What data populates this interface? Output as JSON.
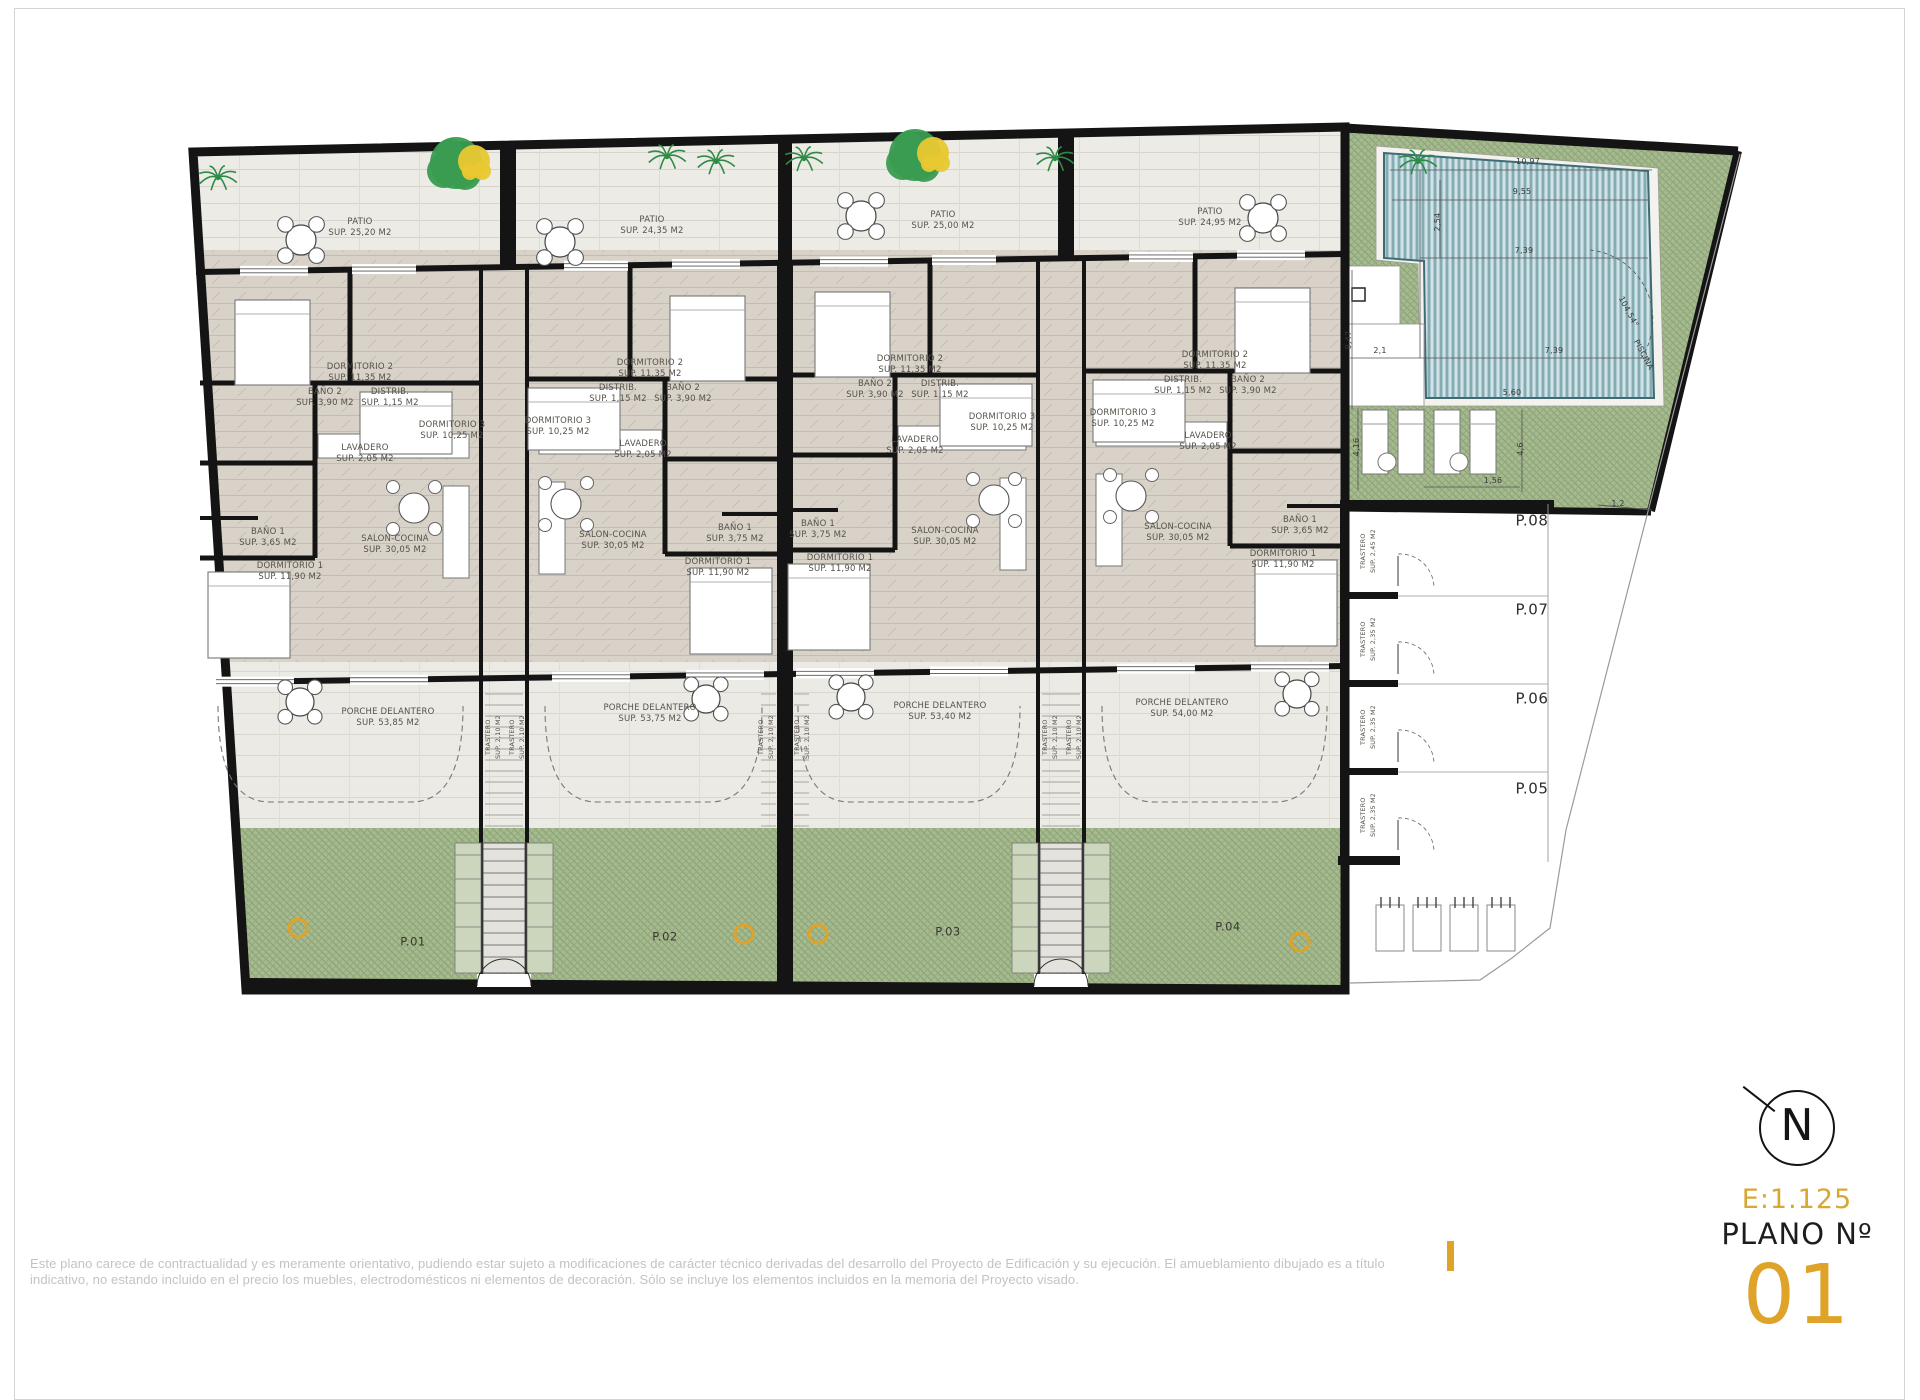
{
  "sheet": {
    "disclaimer_line1": "Este plano carece de contractualidad y es meramente orientativo, pudiendo estar sujeto a modificaciones de carácter técnico derivadas del desarrollo del Proyecto de Edificación y su ejecución. El amueblamiento dibujado es a título",
    "disclaimer_line2": "indicativo, no estando incluido en el precio los muebles, electrodomésticos ni elementos de decoración. Sólo se incluye los elementos incluidos en la memoria del Proyecto visado.",
    "plan_scale": "E:1.125",
    "plan_no_label": "PLANO Nº",
    "plan_number": "01",
    "north_letter": "N",
    "accent_color": "#DFA32A"
  },
  "patios": [
    {
      "name": "PATIO",
      "sup": "SUP. 25,20 M2"
    },
    {
      "name": "PATIO",
      "sup": "SUP. 24,35 M2"
    },
    {
      "name": "PATIO",
      "sup": "SUP. 25,00 M2"
    },
    {
      "name": "PATIO",
      "sup": "SUP. 24,95 M2"
    }
  ],
  "units": [
    {
      "id": "P.01",
      "porch_name": "PORCHE DELANTERO",
      "porch_sup": "SUP. 53,85 M2",
      "rooms": {
        "dormitorio2": {
          "name": "DORMITORIO 2",
          "sup": "SUP. 11,35 M2"
        },
        "dormitorio3": {
          "name": "DORMITORIO 3",
          "sup": "SUP. 10,25 M2"
        },
        "bano2": {
          "name": "BAÑO 2",
          "sup": "SUP. 3,90 M2"
        },
        "distrib": {
          "name": "DISTRIB.",
          "sup": "SUP. 1,15 M2"
        },
        "lavadero": {
          "name": "LAVADERO",
          "sup": "SUP. 2,05 M2"
        },
        "bano1": {
          "name": "BAÑO 1",
          "sup": "SUP. 3,65 M2"
        },
        "dormitorio1": {
          "name": "DORMITORIO 1",
          "sup": "SUP. 11,90 M2"
        },
        "salon": {
          "name": "SALON-COCINA",
          "sup": "SUP. 30,05 M2"
        }
      }
    },
    {
      "id": "P.02",
      "porch_name": "PORCHE DELANTERO",
      "porch_sup": "SUP. 53,75 M2",
      "rooms": {
        "dormitorio2": {
          "name": "DORMITORIO 2",
          "sup": "SUP. 11,35 M2"
        },
        "dormitorio3": {
          "name": "DORMITORIO 3",
          "sup": "SUP. 10,25 M2"
        },
        "bano2": {
          "name": "BAÑO 2",
          "sup": "SUP. 3,90 M2"
        },
        "distrib": {
          "name": "DISTRIB.",
          "sup": "SUP. 1,15 M2"
        },
        "lavadero": {
          "name": "LAVADERO",
          "sup": "SUP. 2,05 M2"
        },
        "bano1": {
          "name": "BAÑO 1",
          "sup": "SUP. 3,75 M2"
        },
        "dormitorio1": {
          "name": "DORMITORIO 1",
          "sup": "SUP. 11,90 M2"
        },
        "salon": {
          "name": "SALON-COCINA",
          "sup": "SUP. 30,05 M2"
        }
      }
    },
    {
      "id": "P.03",
      "porch_name": "PORCHE DELANTERO",
      "porch_sup": "SUP. 53,40 M2",
      "rooms": {
        "dormitorio2": {
          "name": "DORMITORIO 2",
          "sup": "SUP. 11,35 M2"
        },
        "dormitorio3": {
          "name": "DORMITORIO 3",
          "sup": "SUP. 10,25 M2"
        },
        "bano2": {
          "name": "BAÑO 2",
          "sup": "SUP. 3,90 M2"
        },
        "distrib": {
          "name": "DISTRIB.",
          "sup": "SUP. 1,15 M2"
        },
        "lavadero": {
          "name": "LAVADERO",
          "sup": "SUP. 2,05 M2"
        },
        "bano1": {
          "name": "BAÑO 1",
          "sup": "SUP. 3,75 M2"
        },
        "dormitorio1": {
          "name": "DORMITORIO 1",
          "sup": "SUP. 11,90 M2"
        },
        "salon": {
          "name": "SALON-COCINA",
          "sup": "SUP. 30,05 M2"
        }
      }
    },
    {
      "id": "P.04",
      "porch_name": "PORCHE DELANTERO",
      "porch_sup": "SUP. 54,00 M2",
      "rooms": {
        "dormitorio2": {
          "name": "DORMITORIO 2",
          "sup": "SUP. 11,35 M2"
        },
        "dormitorio3": {
          "name": "DORMITORIO 3",
          "sup": "SUP. 10,25 M2"
        },
        "bano2": {
          "name": "BAÑO 2",
          "sup": "SUP. 3,90 M2"
        },
        "distrib": {
          "name": "DISTRIB.",
          "sup": "SUP. 1,15 M2"
        },
        "lavadero": {
          "name": "LAVADERO",
          "sup": "SUP. 2,05 M2"
        },
        "bano1": {
          "name": "BAÑO 1",
          "sup": "SUP. 3,65 M2"
        },
        "dormitorio1": {
          "name": "DORMITORIO 1",
          "sup": "SUP. 11,90 M2"
        },
        "salon": {
          "name": "SALON-COCINA",
          "sup": "SUP. 30,05 M2"
        }
      }
    }
  ],
  "stair_trastero": {
    "name": "TRASTERO",
    "sup": "SUP. 2,10 M2"
  },
  "storage_rows": [
    {
      "id": "P.08",
      "name": "TRASTERO",
      "sup": "SUP. 2,45 M2"
    },
    {
      "id": "P.07",
      "name": "TRASTERO",
      "sup": "SUP. 2,35 M2"
    },
    {
      "id": "P.06",
      "name": "TRASTERO",
      "sup": "SUP. 2,35 M2"
    },
    {
      "id": "P.05",
      "name": "TRASTERO",
      "sup": "SUP. 2,35 M2"
    }
  ],
  "pool": {
    "label": "PISCINA",
    "dim_top": "10,97",
    "dim_upper": "9,55",
    "dim_mid": "7,39",
    "dim_lower_right": "7,39",
    "dim_lower_left": "2,1",
    "dim_left_vert": "9,47",
    "dim_inner_vert": "2,54",
    "angle": "104,54°",
    "dim_beds_left": "4,16",
    "dim_beds_right": "4,6",
    "dim_beds_small": "1,56",
    "dim_deck": "5,60",
    "dim_gap": "1,2"
  }
}
